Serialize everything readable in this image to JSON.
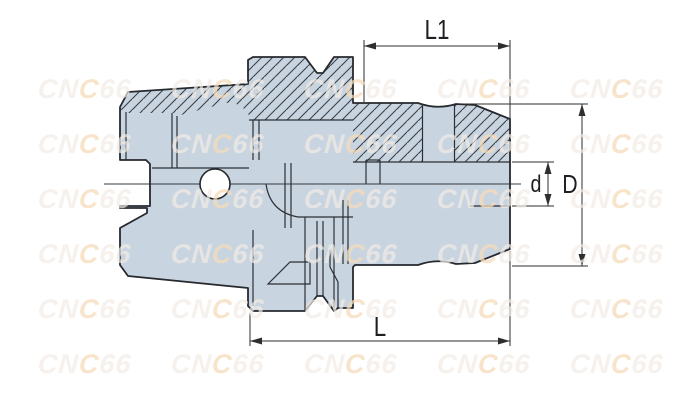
{
  "title": "tool-holder-technical-drawing",
  "dimensions": {
    "l1": {
      "label": "L1"
    },
    "l": {
      "label": "L"
    },
    "big_d": {
      "label": "D"
    },
    "small_d": {
      "label": "d"
    }
  },
  "watermark": {
    "text": "CNC66",
    "seg1": "CN",
    "accent": "C",
    "seg2": "66",
    "base_color": "rgba(242,235,228,0.7)",
    "accent_color": "rgba(246,219,184,0.75)",
    "positions": [
      [
        38,
        78
      ],
      [
        171,
        78
      ],
      [
        304,
        78
      ],
      [
        437,
        78
      ],
      [
        570,
        78
      ],
      [
        38,
        133
      ],
      [
        171,
        133
      ],
      [
        304,
        133
      ],
      [
        437,
        133
      ],
      [
        570,
        133
      ],
      [
        38,
        188
      ],
      [
        171,
        188
      ],
      [
        304,
        188
      ],
      [
        437,
        188
      ],
      [
        570,
        188
      ],
      [
        38,
        243
      ],
      [
        171,
        243
      ],
      [
        304,
        243
      ],
      [
        437,
        243
      ],
      [
        570,
        243
      ],
      [
        38,
        298
      ],
      [
        171,
        298
      ],
      [
        304,
        298
      ],
      [
        437,
        298
      ],
      [
        570,
        298
      ],
      [
        38,
        353
      ],
      [
        171,
        353
      ],
      [
        304,
        353
      ],
      [
        437,
        353
      ],
      [
        570,
        353
      ]
    ]
  },
  "colors": {
    "part_fill": "#c8d5e1",
    "outline": "#26292e",
    "inner_line": "#2b2f34",
    "hatch_line": "#3a4046",
    "dim_line": "#2e2e2e",
    "background": "#ffffff"
  }
}
